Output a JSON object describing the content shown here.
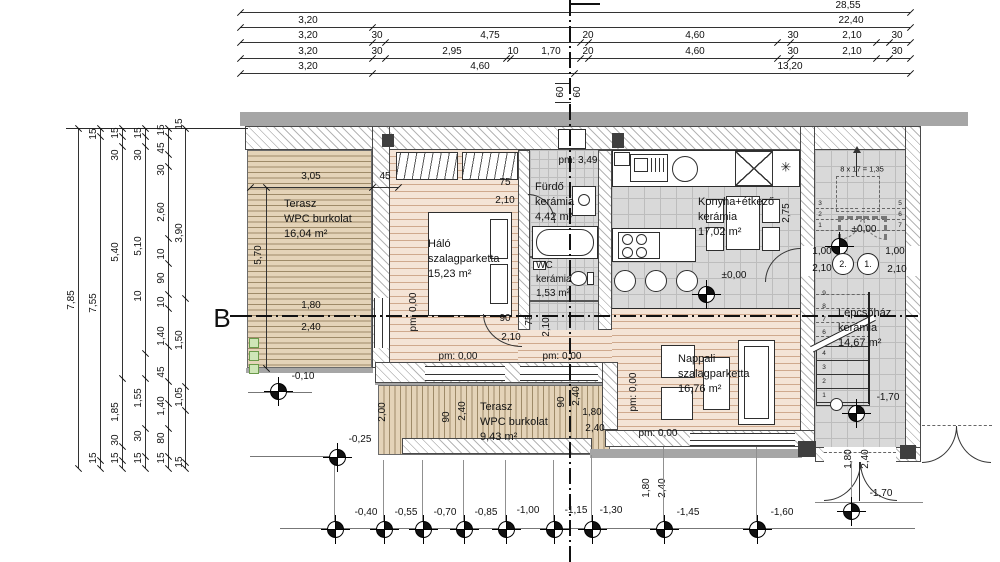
{
  "section": {
    "letter": "B"
  },
  "top": {
    "r1": [
      "28,55"
    ],
    "r2": [
      "3,20",
      "22,40"
    ],
    "r3": [
      "3,20",
      "30",
      "4,75",
      "20",
      "4,60",
      "30",
      "2,10",
      "30"
    ],
    "r4": [
      "3,20",
      "30",
      "2,95",
      "10",
      "1,70",
      "20",
      "4,60",
      "30",
      "2,10",
      "30"
    ],
    "r5": [
      "3,20",
      "4,60",
      "13,20"
    ]
  },
  "left": {
    "c1": [
      "7,85"
    ],
    "c2": [
      "15",
      "7,55",
      "15"
    ],
    "c3": [
      "15",
      "30",
      "5,40",
      "1,85",
      "30",
      "15"
    ],
    "c4": [
      "15",
      "30",
      "5,10",
      "10",
      "1,55",
      "30",
      "15"
    ],
    "c5": [
      "15",
      "45",
      "30",
      "2,60",
      "10",
      "90",
      "10",
      "1,40",
      "45",
      "1,40",
      "80",
      "15"
    ],
    "c6": [
      "15",
      "3,90",
      "1,50",
      "1,05",
      "15"
    ]
  },
  "rooms": {
    "terasz1": {
      "name": "Terasz",
      "finish": "WPC burkolat",
      "area": "16,04 m²"
    },
    "halo": {
      "name": "Háló",
      "finish": "szalagparketta",
      "area": "15,23 m²"
    },
    "furdo": {
      "name": "Fürdő",
      "finish": "kerámia",
      "area": "4,42 m²"
    },
    "wc": {
      "name": "WC",
      "finish": "kerámia",
      "area": "1,53 m²"
    },
    "konyha": {
      "name": "Konyha+étkező",
      "finish": "kerámia",
      "area": "17,02 m²"
    },
    "nappali": {
      "name": "Nappali",
      "finish": "szalagparketta",
      "area": "16,76 m²"
    },
    "terasz2": {
      "name": "Terasz",
      "finish": "WPC burkolat",
      "area": "9,43 m²"
    },
    "lepcso": {
      "name": "Lépcsőház",
      "finish": "kerámia",
      "area": "14,67 m²"
    }
  },
  "levels": {
    "p349": "pm: 3,49",
    "p0": "pm: 0,00",
    "zero": "±0,00",
    "m010": "-0,10",
    "m025": "-0,25",
    "m040": "-0,40",
    "m055": "-0,55",
    "m070": "-0,70",
    "m085": "-0,85",
    "m100": "-1,00",
    "m115": "-1,15",
    "m130": "-1,30",
    "m145": "-1,45",
    "m160": "-1,60",
    "m170": "-1,70"
  },
  "pd": {
    "d305": "3,05",
    "d45": "45",
    "d570": "5,70",
    "d75": "75",
    "d210": "2,10",
    "d180": "1,80",
    "d240": "2,40",
    "d90": "90",
    "d275": "2,75",
    "d200": "2,00",
    "d60": "60",
    "d100": "1,00",
    "stair_note": "8 x 17 = 1,35"
  },
  "doors": {
    "t1": "1.",
    "t2": "2."
  },
  "nums": {
    "n1": "1",
    "n2": "2",
    "n3": "3",
    "n4": "4",
    "n5": "5",
    "n6": "6",
    "n7": "7",
    "n8": "8",
    "n9": "9"
  },
  "icons": {
    "snowflake": "✳",
    "level_marker": "quadrant-circle"
  },
  "colors": {
    "deck": "#e4d3b8",
    "deck_line": "#9e8a68",
    "parquet": "#f4e4d6",
    "parquet_line": "#cfa98d",
    "tile": "#d9d9d9",
    "wall_hatch": "#b5b5b5",
    "gray_strip": "#a6a6a6",
    "dark_fill": "#3f3f3f",
    "plant_green": "#6a9a4a"
  }
}
